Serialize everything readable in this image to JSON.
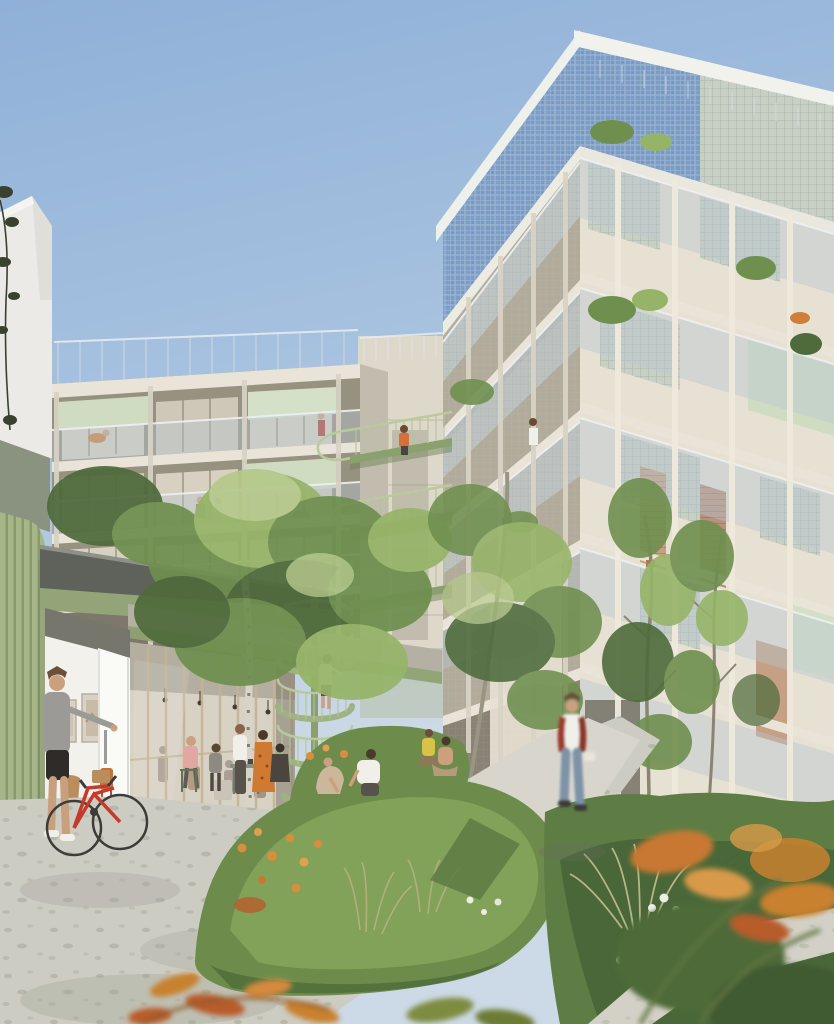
{
  "scene": {
    "type": "architectural-rendering",
    "setting": "residential courtyard garden between two apartment wings",
    "sky": "clear blue daylight",
    "features": "green steel walkways, spiral staircase, ground-floor gallery and cafe, lush perennial garden"
  },
  "palette": {
    "sky_top": "#8fb0d8",
    "sky_mid": "#aac4e0",
    "sky_low": "#ccd9e6",
    "white_building": "#ebeae6",
    "facade_light": "#e7e1d3",
    "facade_mid": "#d6d0c2",
    "facade_shade": "#b2ab9b",
    "facade_dark": "#97917f",
    "slab": "#e9e4d7",
    "blue_tiles": "#7d9cc4",
    "blue_tile_line": "#a9c0da",
    "glass_block": "#c8d0c5",
    "glass_block_line": "#aab4aa",
    "balustrade_glass": "#b7c5d2",
    "awning_green": "#cfdcc2",
    "shutter_terracotta": "#c5a084",
    "walkway_green": "#8ba06f",
    "stair_green": "#9fb382",
    "ribbed_wall": "#a7b689",
    "ribbed_wall_line": "#8a996d",
    "olive_roof": "#8a937f",
    "canopy_roof": "#5f625a",
    "canopy_fascia": "#93a578",
    "gallery_white": "#f2f1ec",
    "glazing_interior": "#d8d2c4",
    "foliage_dark": "#4f6b3c",
    "foliage_mid": "#6f8f4f",
    "foliage_light": "#96b468",
    "autumn_orange": "#c8812f",
    "flower_orange": "#d88e3c",
    "flower_white": "#ecefe4",
    "garden_green": "#6d8c4c",
    "garden_shade": "#4a6636",
    "grass_dry": "#b7b083",
    "path": "#cdccc3",
    "path_light": "#d8d6cc",
    "leaf_litter": "#7e8a72",
    "bike_red": "#c43b2c",
    "skin": "#caa07f",
    "jeans": "#7e93a8",
    "jacket_red": "#9c3a2c",
    "birch_bark": "#d8d5c8"
  },
  "inventory": {
    "left_wing_floors_visible": 4,
    "right_wing_floors_visible": 6,
    "walkway_bridges": 3,
    "spiral_stairs": 1,
    "people_in_courtyard": 12,
    "bicycles": 1,
    "framed_artworks": 2
  }
}
